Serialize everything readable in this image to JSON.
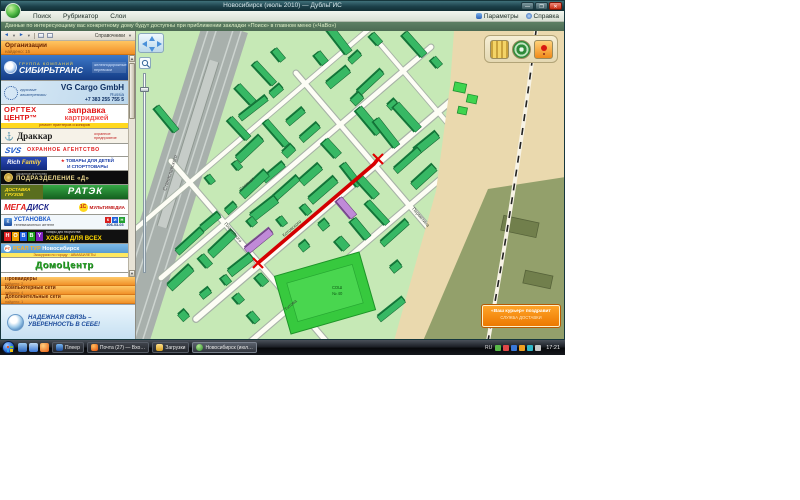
{
  "window": {
    "title": "Новосибирск (июль 2010)  —  ДубльГИС",
    "controls": {
      "minimize": "—",
      "maximize": "❐",
      "close": "✕"
    },
    "menu": {
      "items": [
        "Поиск",
        "Рубрикатор",
        "Слои"
      ],
      "right": [
        {
          "label": "Параметры"
        },
        {
          "label": "Справка"
        }
      ]
    },
    "hint": "Данные по интересующему вас конкретному дому будут доступны при приближении закладки «Поиск» в главном меню («ЧаВо»)"
  },
  "sidebar": {
    "toolbar": {
      "back": "◄",
      "forward": "►",
      "caret": "▼",
      "references": "Справочники"
    },
    "header": {
      "title": "Организации",
      "count": "найдено: 15"
    },
    "banners": {
      "sibtrans": {
        "top": "ГРУППА КОМПАНИЙ",
        "name": "СИБИРЬТРАНС",
        "note": "железнодорожные перевозки"
      },
      "vgcargo": {
        "left": "грузовые авиаперевозки",
        "name": "VG Cargo GmbH",
        "country": "Russia",
        "phone": "+7 383 255 755 5"
      },
      "orgtech": {
        "l1": "ОРГТЕХ",
        "l2": "ЦЕНТР™",
        "r1": "заправка",
        "r2": "картриджей",
        "strip": "ремонт принтеров и копиров"
      },
      "drakkar": {
        "name": "Драккар",
        "note": "охранное предприятие"
      },
      "svs": {
        "logo": "SVS",
        "text": "ОХРАННОЕ АГЕНТСТВО"
      },
      "rich": {
        "logo_b": "Rich",
        "logo_y": " Family",
        "l1": "ТОВАРЫ ДЛЯ ДЕТЕЙ",
        "l2": "И СПОРТТОВАРЫ",
        "star": "★"
      },
      "podrazd": {
        "top": "охранное агентство",
        "name": "ПОДРАЗДЕЛЕНИЕ «Д»"
      },
      "ratek": {
        "l1": "ДОСТАВКА",
        "l2": "ГРУЗОВ",
        "name": "РАТЭК"
      },
      "megadisk": {
        "mega": "МЕГА",
        "disk": "ДИСК",
        "c1": "1С",
        "mm": "МУЛЬТИМЕДИА"
      },
      "antenna": {
        "logo": "К",
        "l1": "УСТАНОВКА",
        "l2": "телевизионных антенн",
        "t0": "К",
        "t1": "И",
        "t2": "Н",
        "phone": "306-03-03"
      },
      "hobby": {
        "t0": "H",
        "t1": "O",
        "t2": "B",
        "t3": "B",
        "t4": "Y",
        "top": "товары для творчества",
        "ru": "ХОББИ ДЛЯ ВСЕХ"
      },
      "realtour": {
        "logo": "РТ",
        "name_hl": "РЕАЛ ТУР",
        "name": " Новосибирск",
        "strip": "Экскурсии по городу · АВИАБИЛЕТЫ"
      },
      "domocentr": {
        "name": "ДомоЦентр"
      }
    },
    "sections": [
      {
        "label": "Провайдеры",
        "count": "найдено: 2"
      },
      {
        "label": "Компьютерные сети",
        "count": "найдено: 4"
      },
      {
        "label": "Дополнительные сети",
        "count": "найдено: 1"
      }
    ],
    "bottom_banner": {
      "l1": "НАДЕЖНАЯ СВЯЗЬ –",
      "l2": "УВЕРЕННОСТЬ В СЕБЕ!"
    }
  },
  "map": {
    "streets": {
      "kotovskogo": "Котовского",
      "stepnaya": "Степная",
      "titova": "Титова",
      "permitina": "Пермитина",
      "plakhotnogo": "Плахотного",
      "stanislavskogo": "Станиславского"
    },
    "stadium": {
      "l1": "СОШ",
      "l2": "№ 40"
    },
    "ad_button": {
      "l1": "«Ваш курьер» поздравит",
      "l2": "СЛУЖБА ДОСТАВКИ"
    }
  },
  "taskbar": {
    "buttons": [
      {
        "label": "Плеер"
      },
      {
        "label": "Почта (27) — Вхо…"
      },
      {
        "label": "Загрузки"
      },
      {
        "label": "Новосибирск (июл…"
      }
    ],
    "tray": {
      "lang": "RU",
      "clock": "17:21"
    }
  }
}
